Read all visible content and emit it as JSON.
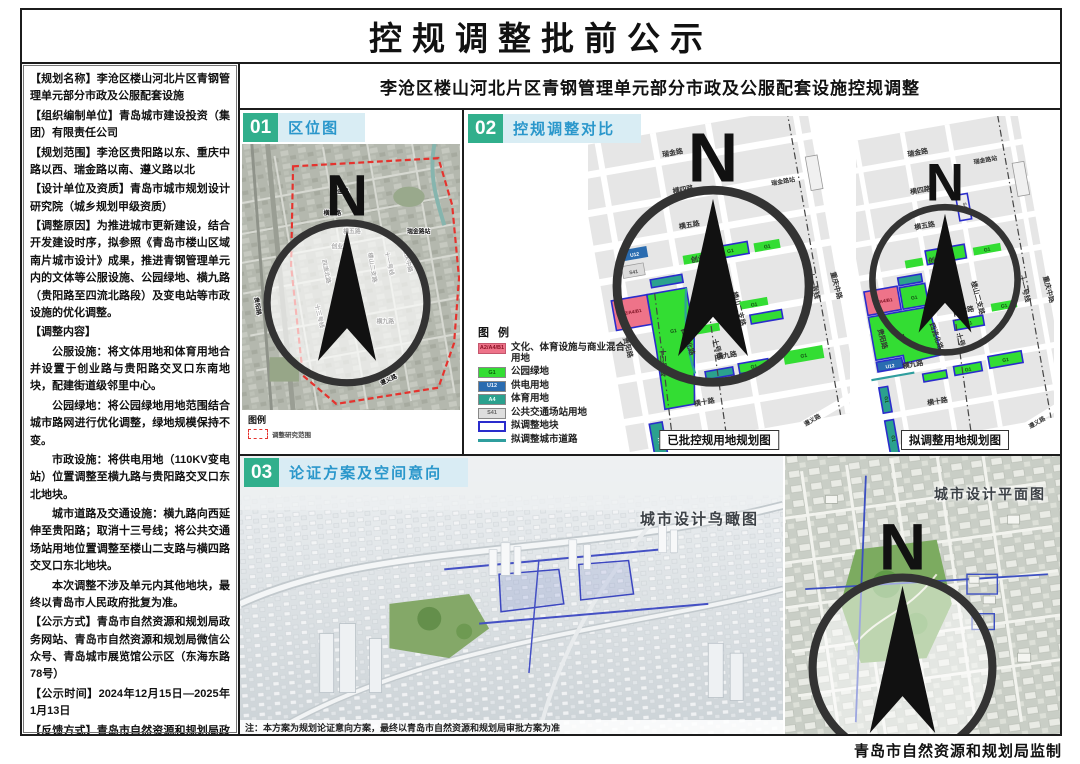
{
  "page": {
    "title": "控规调整批前公示",
    "subtitle": "李沧区楼山河北片区青钢管理单元部分市政及公服配套设施控规调整",
    "credit": "青岛市自然资源和规划局监制"
  },
  "sidebar": {
    "blocks": [
      {
        "text": "【规划名称】李沧区楼山河北片区青钢管理单元部分市政及公服配套设施"
      },
      {
        "text": "【组织编制单位】青岛城市建设投资（集团）有限责任公司"
      },
      {
        "text": "【规划范围】李沧区贵阳路以东、重庆中路以西、瑞金路以南、遵义路以北"
      },
      {
        "text": "【设计单位及资质】青岛市城市规划设计研究院（城乡规划甲级资质）"
      },
      {
        "text": "【调整原因】为推进城市更新建设，结合开发建设时序，拟参照《青岛市楼山区域南片城市设计》成果，推进青钢管理单元内的文体等公服设施、公园绿地、横九路（贵阳路至四流北路段）及变电站等市政设施的优化调整。"
      },
      {
        "text": "【调整内容】"
      },
      {
        "text": "公服设施：将文体用地和体育用地合并设置于创业路与贵阳路交叉口东南地块，配建街道级邻里中心。"
      },
      {
        "text": "公园绿地：将公园绿地用地范围结合城市路网进行优化调整，绿地规模保持不变。"
      },
      {
        "text": "市政设施：将供电用地（110KV变电站）位置调整至横九路与贵阳路交叉口东北地块。"
      },
      {
        "text": "城市道路及交通设施：横九路向西延伸至贵阳路；取消十三号线；将公共交通场站用地位置调整至楼山二支路与横四路交叉口东北地块。"
      },
      {
        "text": "本次调整不涉及单元内其他地块，最终以青岛市人民政府批复为准。"
      }
    ],
    "footer_blocks": [
      {
        "text": "【公示方式】青岛市自然资源和规划局政务网站、青岛市自然资源和规划局微信公众号、青岛城市展览馆公示区（东海东路78号）"
      },
      {
        "text": "【公示时间】2024年12月15日—2025年1月13日"
      },
      {
        "text": "【反馈方式】青岛市自然资源和规划局政务网站、青岛城市展览馆公示区意见箱。"
      },
      {
        "text": "【咨询电话】0532-87621361"
      }
    ]
  },
  "sections": {
    "s1": {
      "num": "01",
      "title": "区位图"
    },
    "s2": {
      "num": "02",
      "title": "控规调整对比"
    },
    "s3": {
      "num": "03",
      "title": "论证方案及空间意向"
    }
  },
  "streets": {
    "ruijin": "瑞金路",
    "heng4": "横四路",
    "heng5": "横五路",
    "chuangye": "创业路",
    "heng7": "横七路",
    "heng9": "横九路",
    "heng10": "横十路",
    "zunyi": "遵义路",
    "guiyang": "贵阳路",
    "siliu": "四流北路",
    "loushan": "楼山二支路",
    "chongqing": "重庆中路",
    "station": "瑞金路站",
    "line10": "十号线",
    "line11": "十一号线",
    "line13": "十三号线"
  },
  "codes": {
    "g1": "G1",
    "u12": "U12",
    "a4": "A4",
    "s41": "S41",
    "mix": "A2/A4/B1"
  },
  "location": {
    "legend_title": "图例",
    "legend_item": "调整研究范围"
  },
  "compare": {
    "legend_title": "图 例",
    "legend": [
      {
        "code": "A2/A4/B1",
        "label": "文化、体育设施与商业混合用地"
      },
      {
        "code": "G1",
        "label": "公园绿地"
      },
      {
        "code": "U12",
        "label": "供电用地"
      },
      {
        "code": "A4",
        "label": "体育用地"
      },
      {
        "code": "S41",
        "label": "公共交通场站用地"
      },
      {
        "label": "拟调整地块"
      },
      {
        "label": "拟调整城市道路"
      }
    ],
    "caption_approved": "已批控规用地规划图",
    "caption_proposed": "拟调整用地规划图"
  },
  "scheme": {
    "caption_bird": "城市设计鸟瞰图",
    "caption_plan": "城市设计平面图",
    "note": "注：本方案为规划论证意向方案，最终以青岛市自然资源和规划局审批方案为准"
  },
  "misc": {
    "north": "N"
  },
  "colors": {
    "accent_green": "#31af8c",
    "header_blue": "#2a97cb",
    "header_bg": "#d9edf4",
    "g1_green": "#33dd33",
    "mix_pink": "#ee7389",
    "u12_blue": "#2a6cb0",
    "a4_teal": "#2ba18e",
    "s41_gray": "#dedede",
    "adjust_outline_blue": "#2a2ccc",
    "adjust_road_teal": "#2f9e9e",
    "boundary_red": "#e5332e"
  }
}
